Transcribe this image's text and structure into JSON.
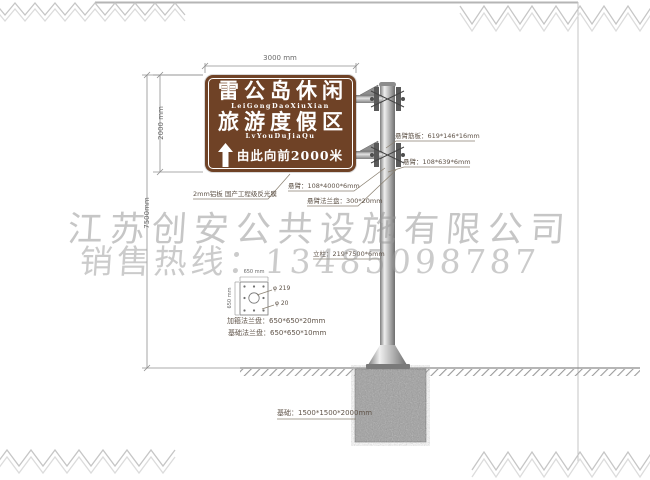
{
  "watermark": {
    "company": "江苏创安公共设施有限公司",
    "hotline": "销售热线：13485098787"
  },
  "sign": {
    "title_line1": "雷公岛休闲",
    "pinyin_line1": "LeiGongDaoXiuXian",
    "title_line2": "旅游度假区",
    "pinyin_line2": "LvYouDuJiaQu",
    "direction_text": "由此向前2000米",
    "arrow_icon": "up-arrow",
    "panel_color": "#6f4226",
    "text_color": "#ffffff"
  },
  "dimensions": {
    "sign_width": "3000 mm",
    "sign_height": "2000 mm",
    "total_height": "7500mm"
  },
  "callouts": {
    "panel_material": "2mm铝板 国产工程级反光膜",
    "arm_rib_plate": "悬臂筋板：619*146*16mm",
    "arm_short": "悬臂：108*639*6mm",
    "arm_long": "悬臂：108*4000*6mm",
    "arm_flange": "悬臂法兰盘：300*20mm",
    "column": "立柱：219*7500*6mm",
    "hoop_flange": "加箍法兰盘：650*650*20mm",
    "base_flange": "基础法兰盘：650*650*10mm",
    "foundation": "基础：1500*1500*2000mm"
  },
  "flange_detail": {
    "dim_width": "650 mm",
    "dim_height": "650 mm",
    "center_hole": "φ 219",
    "bolt_hole": "φ 20"
  },
  "colors": {
    "panel_brown": "#6f4226",
    "watermark_gray": "#999999",
    "line_gray": "#999999"
  }
}
